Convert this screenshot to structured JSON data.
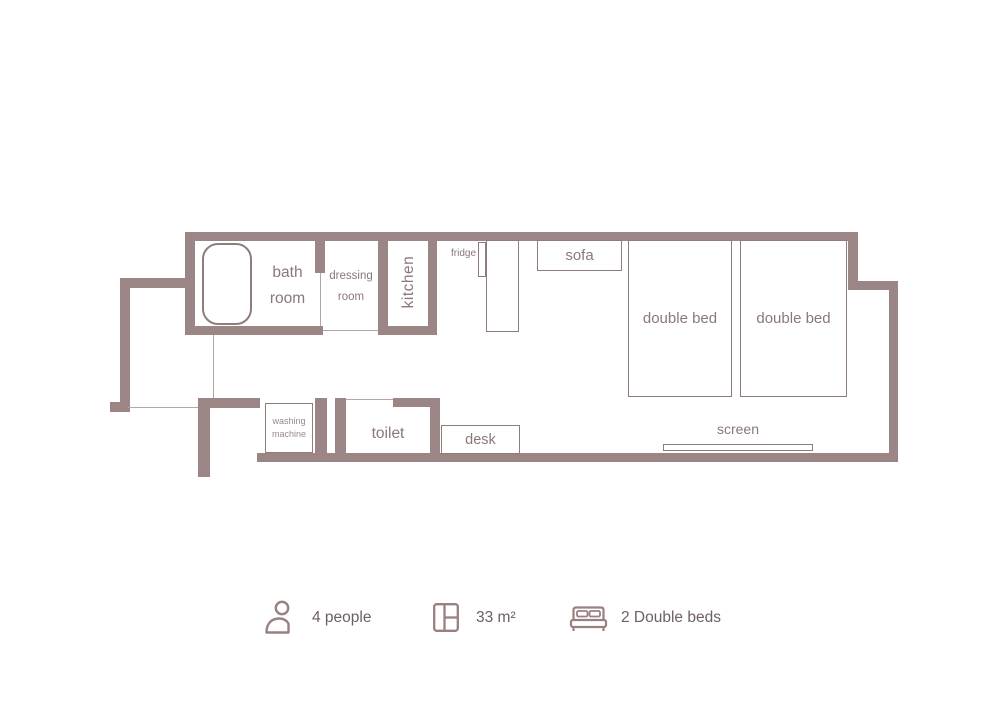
{
  "plan": {
    "bath_room": {
      "line1": "bath",
      "line2": "room"
    },
    "dressing_room": {
      "line1": "dressing",
      "line2": "room"
    },
    "kitchen": "kitchen",
    "fridge": "fridge",
    "sofa": "sofa",
    "double_bed": "double bed",
    "toilet": "toilet",
    "desk": "desk",
    "screen": "screen",
    "washing_machine": {
      "line1": "washing",
      "line2": "machine"
    }
  },
  "legend": {
    "capacity": {
      "icon": "person-icon",
      "label": "4 people"
    },
    "area": {
      "icon": "floorplan-icon",
      "label": "33 m²"
    },
    "beds": {
      "icon": "double-bed-icon",
      "label": "2 Double beds"
    }
  },
  "colors": {
    "wall": "#9b8585",
    "thin_line": "#b5a6a6",
    "furniture_border": "#8f7d7d",
    "room_label": "#8a7878",
    "legend_text": "#6e6060"
  }
}
